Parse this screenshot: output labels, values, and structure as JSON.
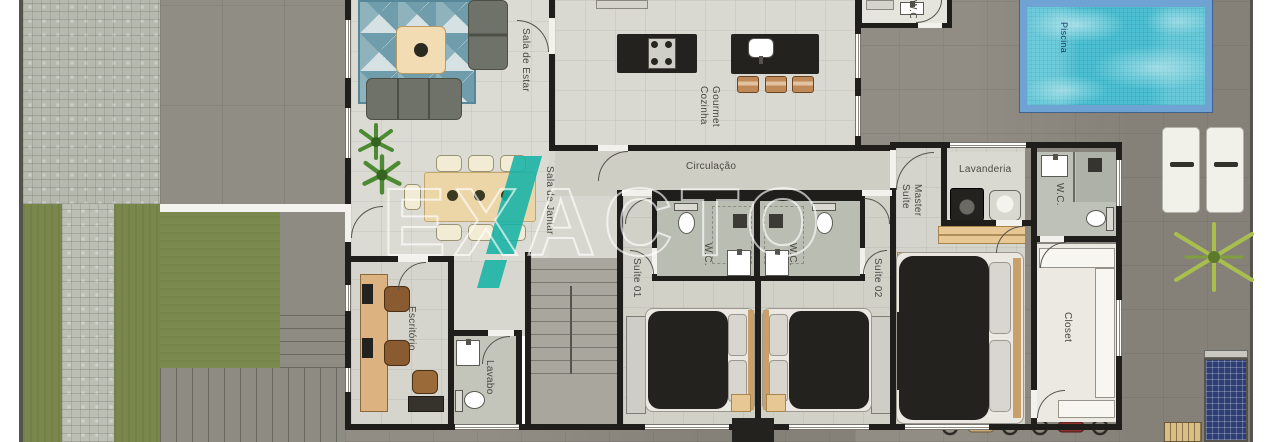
{
  "watermark": {
    "text": "EXACTO"
  },
  "colors": {
    "watermark_accent": "#16b3a6",
    "pool_water": "#4cc0d2",
    "pool_border": "#6fa3d4",
    "lawn": "#79874c",
    "wall": "#1f1e1b",
    "furniture_dark": "#23221f"
  },
  "rooms": {
    "sala_de_estar": {
      "label": "Sala de Estar"
    },
    "sala_de_jantar": {
      "label": "Sala de Jantar"
    },
    "cozinha_gourmet": {
      "label": "Cozinha Gourmet"
    },
    "circulacao": {
      "label": "Circulação"
    },
    "suite_01": {
      "label": "Suíte 01"
    },
    "suite_02": {
      "label": "Suíte 02"
    },
    "suite_master": {
      "label": "Suíte Master"
    },
    "wc_suite_01": {
      "label": "W.C."
    },
    "wc_suite_02": {
      "label": "W.C."
    },
    "wc_master": {
      "label": "W.C."
    },
    "wc_externo": {
      "label": "W.C."
    },
    "lavanderia": {
      "label": "Lavanderia"
    },
    "closet": {
      "label": "Closet"
    },
    "escritorio": {
      "label": "Escritório"
    },
    "lavabo": {
      "label": "Lavabo"
    },
    "piscina": {
      "label": "Piscina"
    }
  }
}
